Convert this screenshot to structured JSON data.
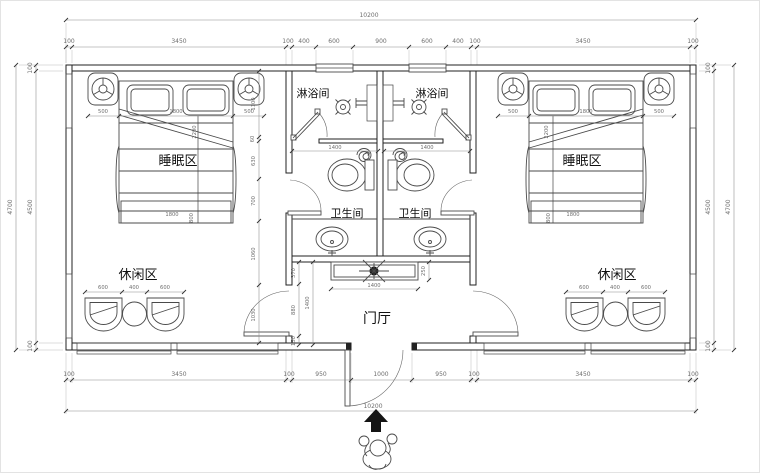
{
  "labels": {
    "sleep_left": "睡眠区",
    "sleep_right": "睡眠区",
    "shower_left": "淋浴间",
    "shower_right": "淋浴间",
    "toilet_left": "卫生间",
    "toilet_right": "卫生间",
    "leisure_left": "休闲区",
    "leisure_right": "休闲区",
    "hall": "门厅"
  },
  "dims": {
    "top_total": "10200",
    "bottom_total": "10200",
    "top_row": [
      "100",
      "3450",
      "100",
      "400",
      "600",
      "900",
      "600",
      "400",
      "100",
      "3450",
      "100"
    ],
    "bottom_row": [
      "100",
      "3450",
      "100",
      "950",
      "1000",
      "950",
      "100",
      "3450",
      "100"
    ],
    "left_outer": "4700",
    "left_inner": [
      "100",
      "4500",
      "100"
    ],
    "right_outer": "4700",
    "right_inner": [
      "100",
      "4500",
      "100"
    ],
    "interior_chain": [
      "1100",
      "60",
      "630",
      "700",
      "1060",
      "1030"
    ],
    "hall_chain": [
      "370",
      "880",
      "150"
    ],
    "hall_height": "1400",
    "cabinet_width": "1400",
    "cabinet_depth": "250",
    "toilet_width_left": "1400",
    "toilet_width_right": "1400",
    "bed_row_left": [
      "500",
      "1800",
      "500"
    ],
    "bed_row_right": [
      "500",
      "1800",
      "500"
    ],
    "bed_foot_left": "1800",
    "bed_foot_right": "1800",
    "bed_foot_h_left": "800",
    "bed_foot_h_right": "800",
    "bed_len_left": "2200",
    "bed_len_right": "2200",
    "leisure_row_left": [
      "600",
      "400",
      "600"
    ],
    "leisure_row_right": [
      "600",
      "400",
      "600"
    ]
  },
  "colors": {
    "line": "#222222",
    "dim_text": "#6e6e6e",
    "label_text": "#101010"
  }
}
